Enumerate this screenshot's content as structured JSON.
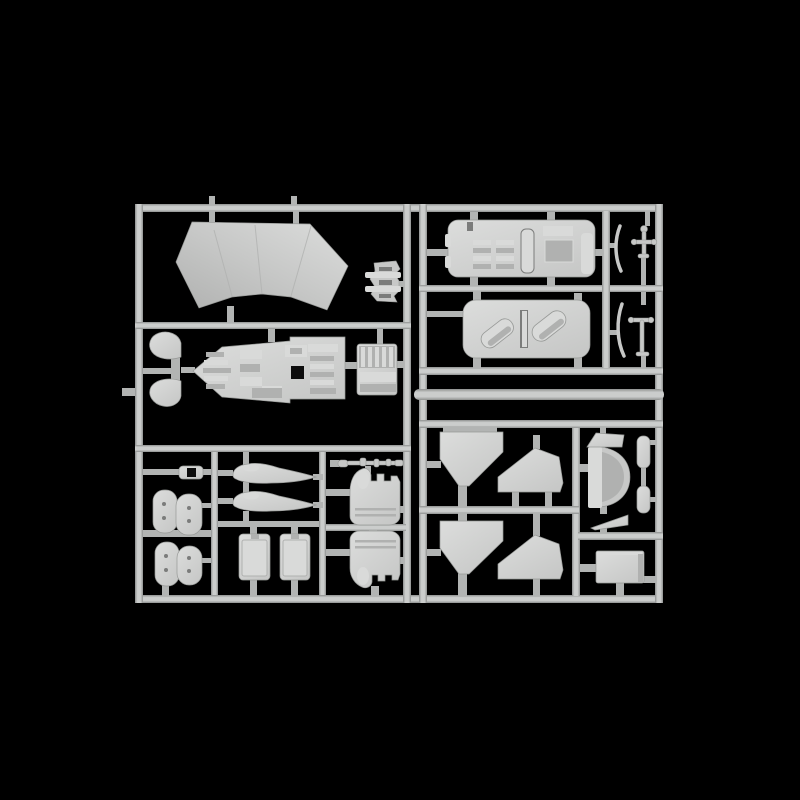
{
  "image": {
    "alt": "Light grey injection-moulded plastic model kit sprue with helicopter parts, photographed on a black background",
    "type": "product-photograph",
    "subject": "model-kit-sprue"
  },
  "colors": {
    "background": "#000000",
    "runner_hi": "#cbcdcc",
    "runner_lo": "#8e908f",
    "runner_flat": "#b2b4b3",
    "part": "#c7c8c7",
    "part_hi": "#dcdddc",
    "part_lo": "#979997",
    "detail_light": "#d9dad9",
    "detail_mid": "#b0b1b0",
    "detail_dark": "#7b7c7b",
    "hole": "#0d0d0d"
  },
  "parts": [
    {
      "id": "windscreen",
      "label": "windscreen canopy panel"
    },
    {
      "id": "bracket",
      "label": "hinge bracket"
    },
    {
      "id": "fan-seats",
      "label": "fan shaped seat pair"
    },
    {
      "id": "cockpit-tub",
      "label": "cockpit tub with instrument detail"
    },
    {
      "id": "console",
      "label": "ribbed side console panel"
    },
    {
      "id": "cabin-floor",
      "label": "cabin floor with seat rows"
    },
    {
      "id": "cabin-roof",
      "label": "cabin roof with intake fairings"
    },
    {
      "id": "sticks-upper",
      "label": "control stick set upper"
    },
    {
      "id": "sticks-lower",
      "label": "control stick set lower"
    },
    {
      "id": "spool",
      "label": "spool fitting"
    },
    {
      "id": "cushions-upper",
      "label": "seat cushion pair upper"
    },
    {
      "id": "cushions-lower",
      "label": "seat cushion pair lower"
    },
    {
      "id": "fairing-upper",
      "label": "streamlined tank fairing upper"
    },
    {
      "id": "fairing-lower",
      "label": "streamlined tank fairing lower"
    },
    {
      "id": "box-left",
      "label": "equipment box left"
    },
    {
      "id": "box-right",
      "label": "equipment box right"
    },
    {
      "id": "engine-upper",
      "label": "engine nacelle half upper"
    },
    {
      "id": "engine-lower",
      "label": "engine nacelle half lower"
    },
    {
      "id": "linkage-rod",
      "label": "linkage rod"
    },
    {
      "id": "funnel-upper",
      "label": "tapered bulkhead upper"
    },
    {
      "id": "funnel-lower",
      "label": "tapered bulkhead lower"
    },
    {
      "id": "bulkhead-upper",
      "label": "angled bulkhead upper"
    },
    {
      "id": "bulkhead-lower",
      "label": "angled bulkhead lower"
    },
    {
      "id": "cabin-door",
      "label": "curved cabin door"
    },
    {
      "id": "wedge-upper",
      "label": "door wedge upper"
    },
    {
      "id": "wedge-lower",
      "label": "door wedge lower"
    },
    {
      "id": "strip-upper",
      "label": "trim strip upper"
    },
    {
      "id": "strip-lower",
      "label": "trim strip lower"
    },
    {
      "id": "hatch",
      "label": "access hatch panel"
    }
  ]
}
